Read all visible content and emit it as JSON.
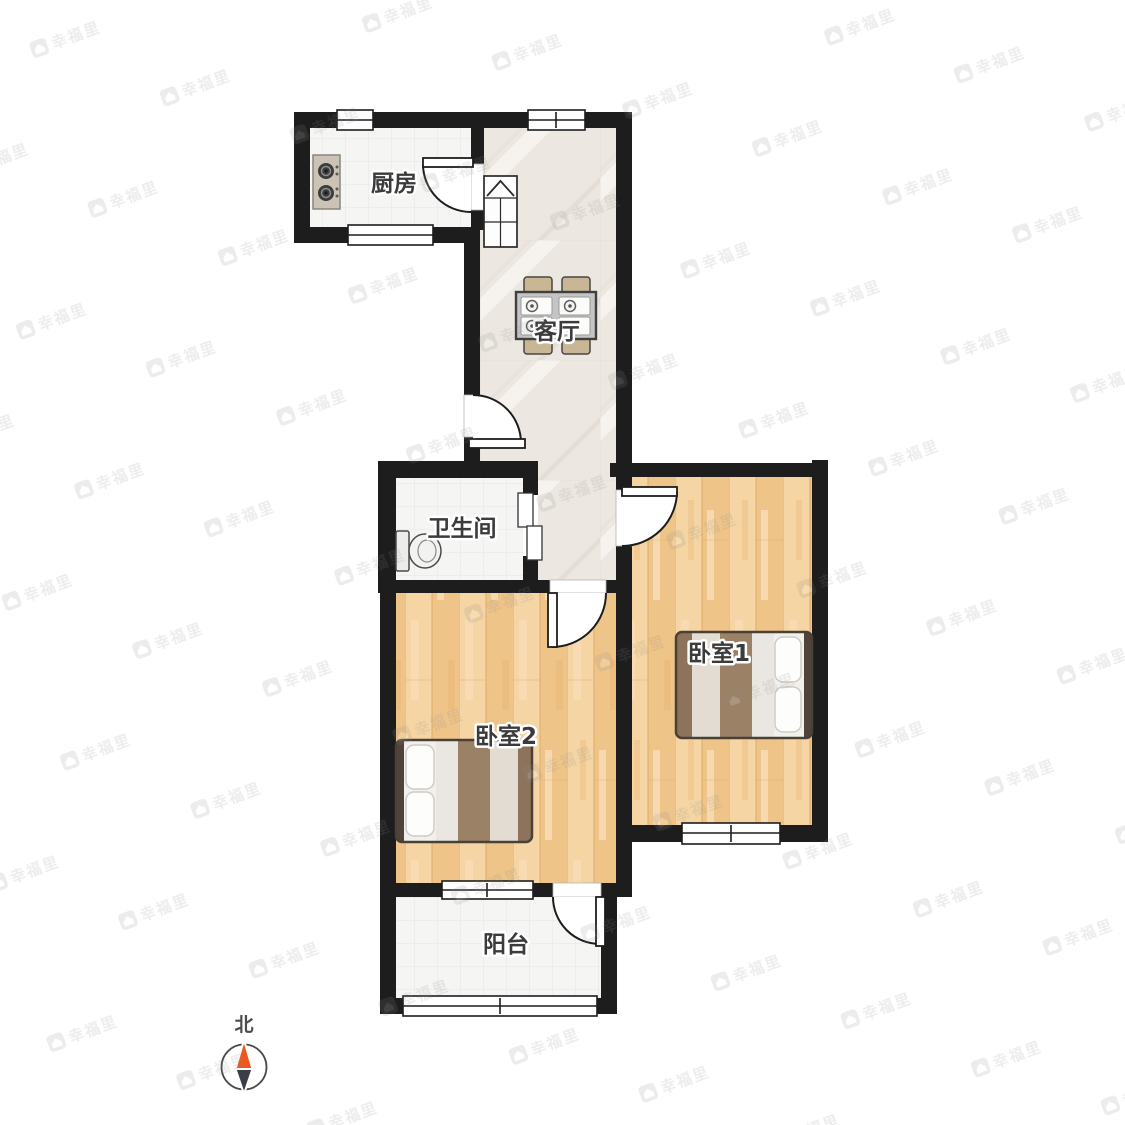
{
  "rooms": {
    "kitchen": {
      "label": "厨房"
    },
    "living_room": {
      "label": "客厅"
    },
    "bathroom": {
      "label": "卫生间"
    },
    "bedroom1": {
      "label": "卧室1"
    },
    "bedroom2": {
      "label": "卧室2"
    },
    "balcony": {
      "label": "阳台"
    }
  },
  "compass": {
    "label": "北",
    "north_color": "#f0561c",
    "south_color": "#3a3f47"
  },
  "watermark": {
    "text": "幸福里"
  },
  "colors": {
    "wall": "#1d1d1d",
    "wood_floor": "#f1ca92",
    "marble_floor": "#ece7e0",
    "tile_floor": "#f5f5f4",
    "bed_blanket": "#9b8165",
    "label_text": "#3b3b3b"
  },
  "icons": {
    "stove": "stove-icon",
    "fridge": "fridge-icon",
    "toilet": "toilet-icon",
    "dining_table": "dining-table-icon",
    "bed": "bed-icon",
    "compass": "compass-icon",
    "watermark_logo": "house-logo-icon"
  }
}
